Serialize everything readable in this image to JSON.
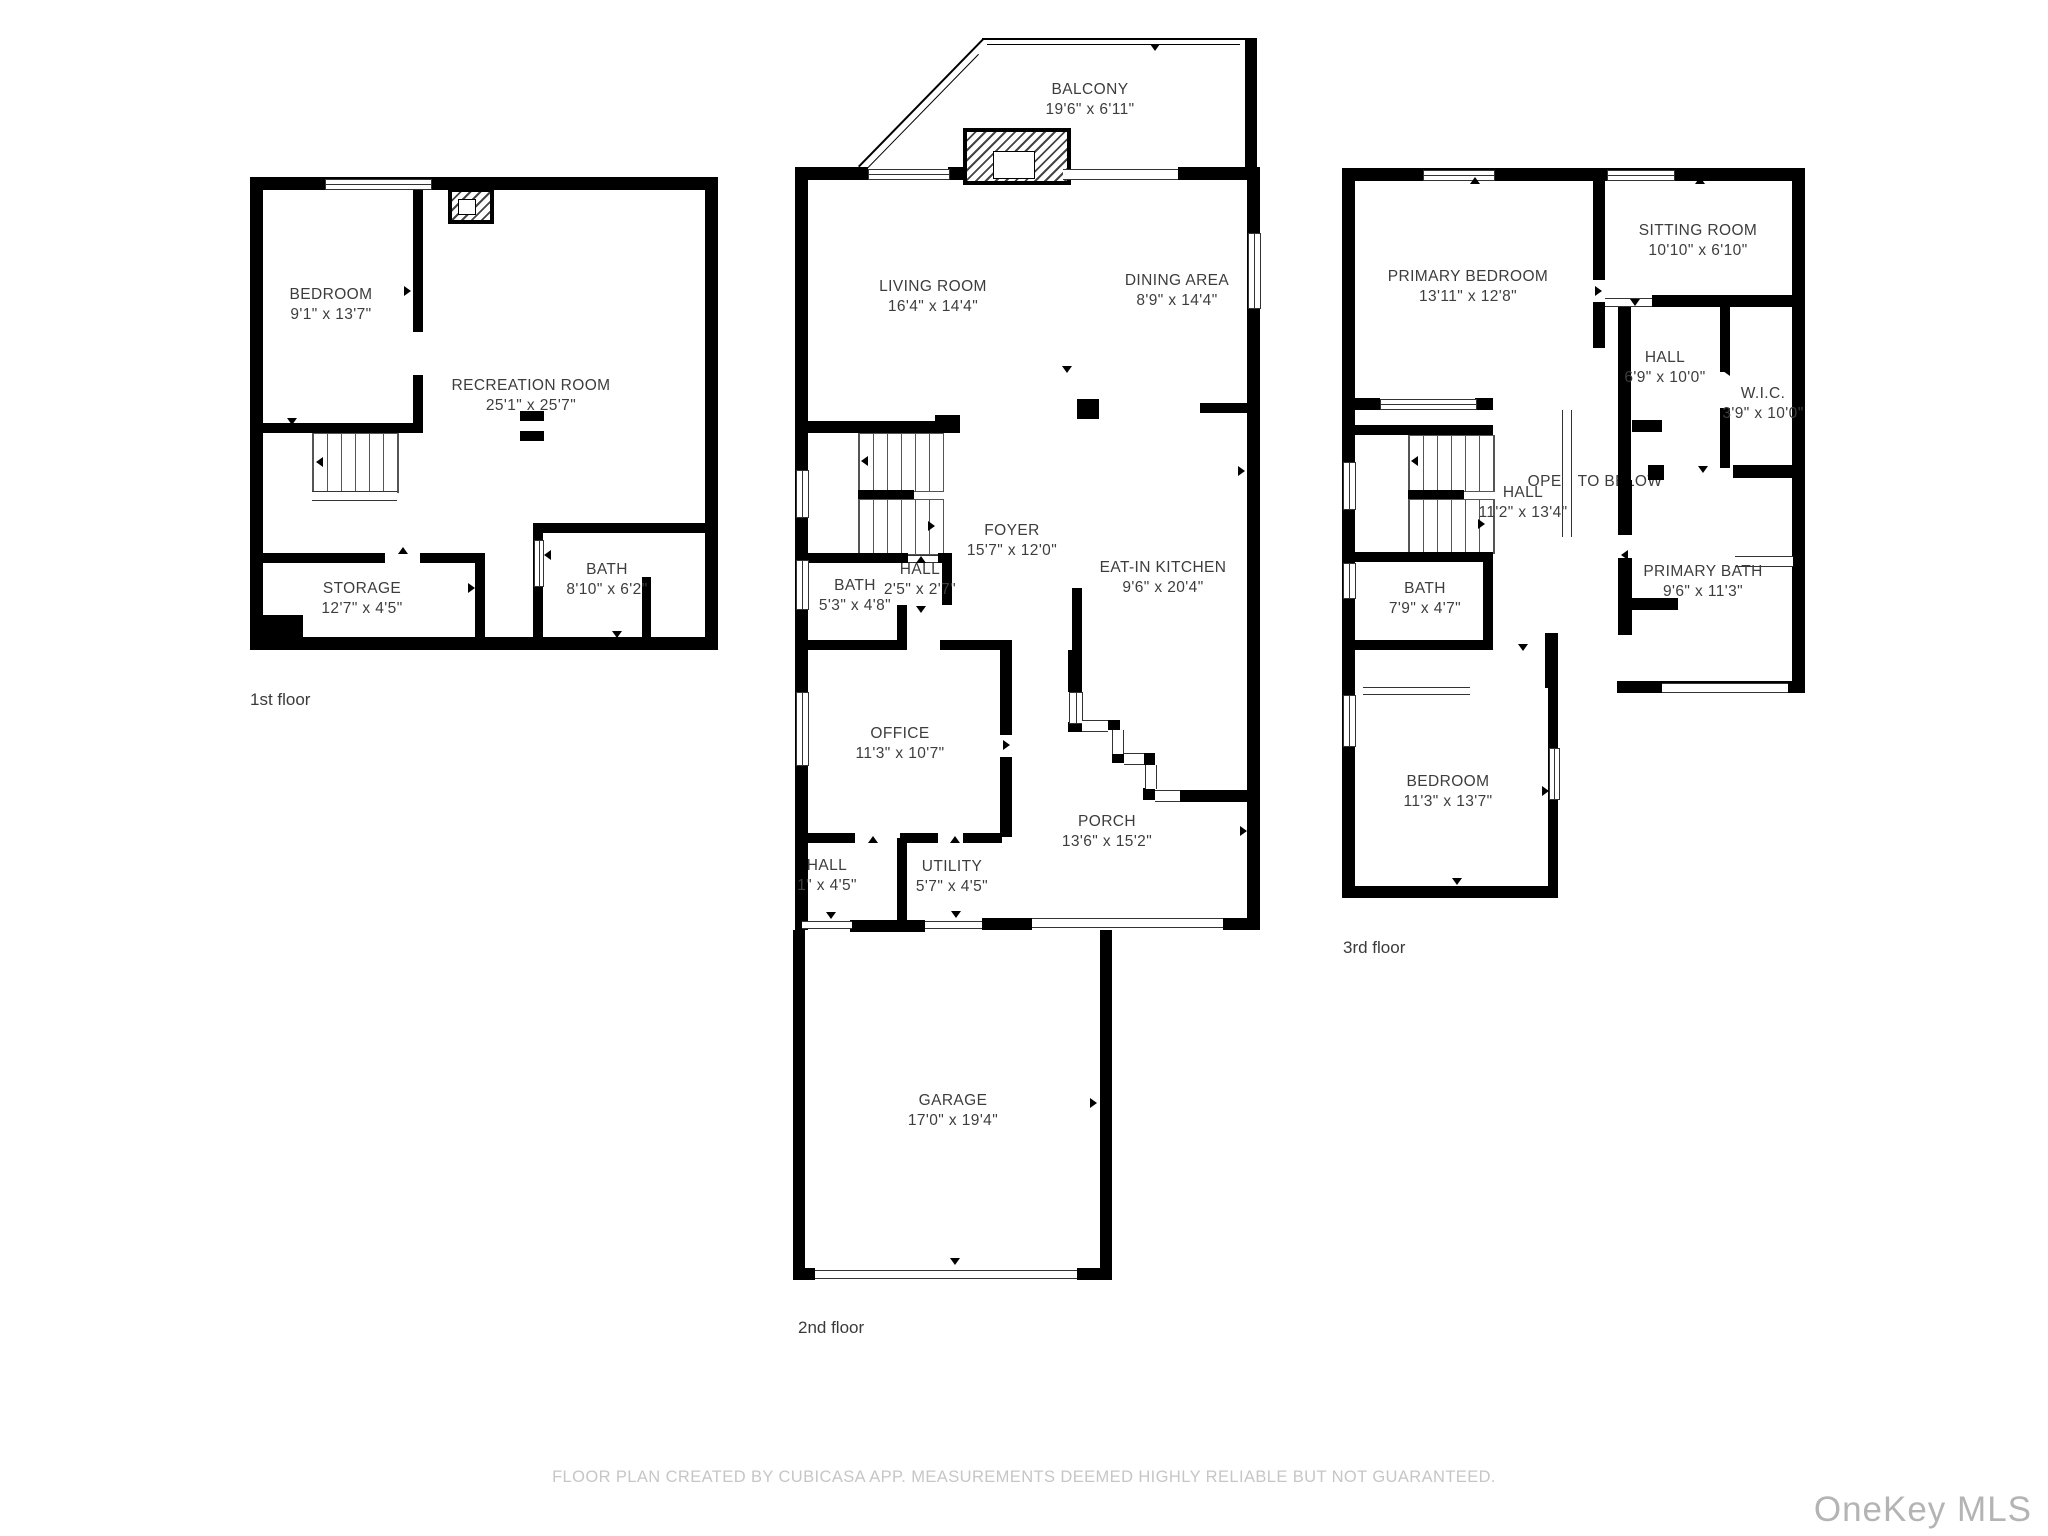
{
  "floor1": {
    "caption": "1st floor",
    "bedroom": {
      "name": "BEDROOM",
      "dims": "9'1\" x 13'7\""
    },
    "recreation": {
      "name": "RECREATION ROOM",
      "dims": "25'1\" x 25'7\""
    },
    "storage": {
      "name": "STORAGE",
      "dims": "12'7\" x 4'5\""
    },
    "bath": {
      "name": "BATH",
      "dims": "8'10\" x 6'2\""
    }
  },
  "floor2": {
    "caption": "2nd floor",
    "balcony": {
      "name": "BALCONY",
      "dims": "19'6\" x 6'11\""
    },
    "living": {
      "name": "LIVING ROOM",
      "dims": "16'4\" x 14'4\""
    },
    "dining": {
      "name": "DINING AREA",
      "dims": "8'9\" x 14'4\""
    },
    "foyer": {
      "name": "FOYER",
      "dims": "15'7\" x 12'0\""
    },
    "hall_upper": {
      "name": "HALL",
      "dims": "2'5\" x 2'7\""
    },
    "bath": {
      "name": "BATH",
      "dims": "5'3\" x 4'8\""
    },
    "kitchen": {
      "name": "EAT-IN KITCHEN",
      "dims": "9'6\" x 20'4\""
    },
    "office": {
      "name": "OFFICE",
      "dims": "11'3\" x 10'7\""
    },
    "hall_lower": {
      "name": "HALL",
      "dims": "1\" x 4'5\""
    },
    "utility": {
      "name": "UTILITY",
      "dims": "5'7\" x 4'5\""
    },
    "porch": {
      "name": "PORCH",
      "dims": "13'6\" x 15'2\""
    },
    "garage": {
      "name": "GARAGE",
      "dims": "17'0\" x 19'4\""
    }
  },
  "floor3": {
    "caption": "3rd floor",
    "primary_bedroom": {
      "name": "PRIMARY BEDROOM",
      "dims": "13'11\" x 12'8\""
    },
    "sitting": {
      "name": "SITTING ROOM",
      "dims": "10'10\" x 6'10\""
    },
    "hall_upper": {
      "name": "HALL",
      "dims": "6'9\" x 10'0\""
    },
    "wic": {
      "name": "W.I.C.",
      "dims": "3'9\" x 10'0\""
    },
    "open_below": {
      "name": "OPEN TO BELOW"
    },
    "hall_mid": {
      "name": "HALL",
      "dims": "11'2\" x 13'4\""
    },
    "bath": {
      "name": "BATH",
      "dims": "7'9\" x 4'7\""
    },
    "primary_bath": {
      "name": "PRIMARY BATH",
      "dims": "9'6\" x 11'3\""
    },
    "bedroom": {
      "name": "BEDROOM",
      "dims": "11'3\" x 13'7\""
    }
  },
  "footer": {
    "disclaimer": "FLOOR PLAN CREATED BY CUBICASA APP. MEASUREMENTS DEEMED HIGHLY RELIABLE BUT NOT GUARANTEED.",
    "watermark": "OneKey MLS"
  },
  "colors": {
    "wall": "#000000",
    "room_label": "#3d3d3d",
    "footer_text": "#c6c6c6",
    "watermark": "#b4b4b4"
  }
}
